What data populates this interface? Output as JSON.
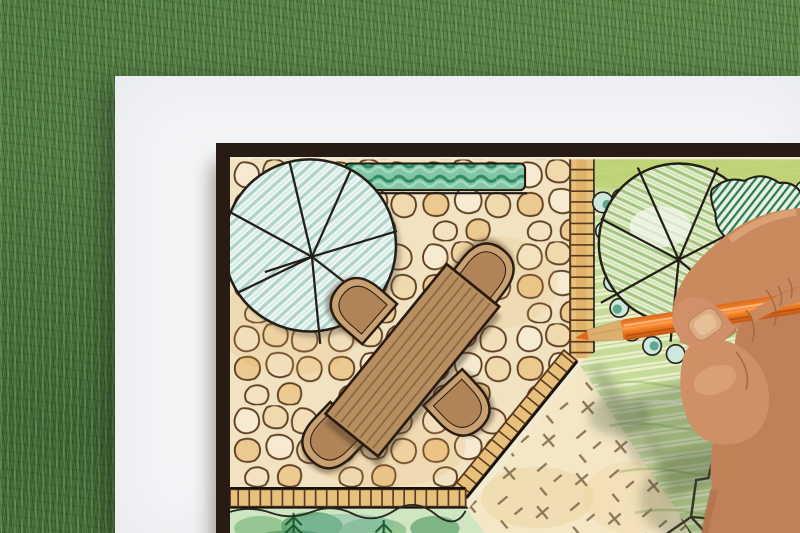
{
  "scene": {
    "description": "Overhead photograph of a hand holding an orange colored pencil over a hand-drawn backyard garden landscape plan on white paper, lying on green grass. The plan shows a flagstone patio with a wooden dining table and four chairs, a large round tree symbol, a clipped hedge, a brick edged path, a striped lawn, scalloped shrub borders and planting beds.",
    "setting": "garden landscape design drawing on grass lawn",
    "palette": {
      "grass_green": "#4f7a41",
      "paper_white": "#f4f5f7",
      "plan_border": "#271b13",
      "flagstone_tan": "#f1e3c2",
      "stone_outline": "#5e3c22",
      "table_brown": "#b68e60",
      "chair_tan": "#c9a072",
      "hedge_teal": "#2f8a68",
      "tree_hatch_teal": "#aed3ca",
      "lawn_green": "#c6db9a",
      "brick_orange": "#e7c07c",
      "pencil_orange": "#f58427",
      "skin_tone": "#c9895e"
    },
    "objects": [
      {
        "name": "grass-background",
        "label": "artificial grass lawn"
      },
      {
        "name": "paper-sheet",
        "label": "white drawing paper"
      },
      {
        "name": "plan-board",
        "label": "dark-bordered landscape plan"
      },
      {
        "name": "patio-flagstones",
        "label": "flagstone patio"
      },
      {
        "name": "dining-table-symbol",
        "label": "wooden table plan symbol"
      },
      {
        "name": "chair-symbol",
        "label": "patio chair plan symbol"
      },
      {
        "name": "deciduous-tree-symbol-left",
        "label": "large round tree symbol"
      },
      {
        "name": "tree-symbol-right",
        "label": "round tree symbol in lawn"
      },
      {
        "name": "garden-hedge",
        "label": "clipped hedge strip"
      },
      {
        "name": "brick-path",
        "label": "brick edging and path"
      },
      {
        "name": "lawn-area",
        "label": "striped lawn"
      },
      {
        "name": "gravel-area-dashed",
        "label": "paved area with dash symbols"
      },
      {
        "name": "planting-beds",
        "label": "planting beds with shrubs"
      },
      {
        "name": "artist-hand",
        "label": "designer's hand"
      },
      {
        "name": "orange-pencil",
        "label": "orange colored pencil"
      }
    ]
  }
}
